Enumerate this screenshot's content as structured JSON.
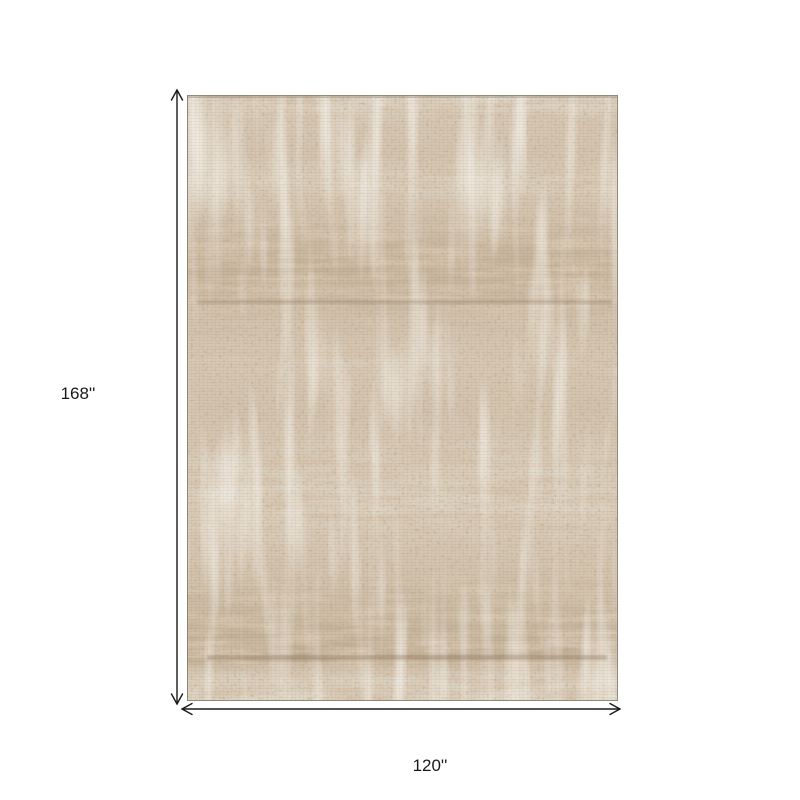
{
  "diagram": {
    "subject": "distressed abstract beige and tan area rug",
    "height_label": "168''",
    "width_label": "120''",
    "colors": {
      "background": "#ffffff",
      "dimension": "#1a1a1a",
      "rug_base": "#e8e2d4",
      "rug_tan": "#b3977a",
      "rug_dark": "#8d7356",
      "rug_light": "#f0ebde",
      "rug_edge": "#8a8275"
    }
  }
}
